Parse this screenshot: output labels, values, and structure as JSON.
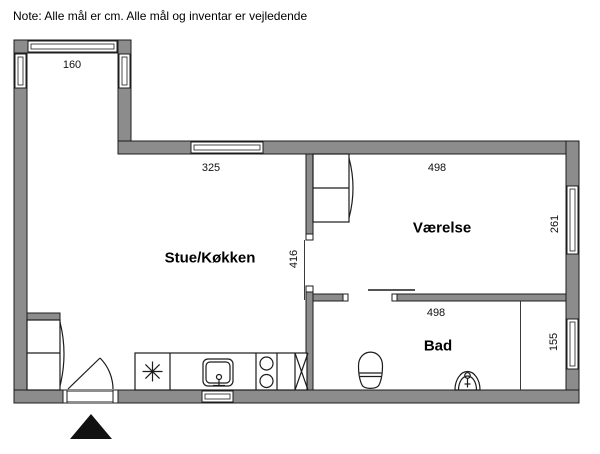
{
  "note": {
    "text": "Note: Alle mål er cm. Alle mål og inventar er vejledende"
  },
  "rooms": {
    "living_kitchen": {
      "label": "Stue/Køkken"
    },
    "bedroom": {
      "label": "Værelse"
    },
    "bathroom": {
      "label": "Bad"
    }
  },
  "dimensions": {
    "entry_bay_width": "160",
    "kitchen_window_wall": "325",
    "bedroom_width": "498",
    "bedroom_depth": "261",
    "living_room_depth": "416",
    "bathroom_width": "498",
    "bathroom_niche_depth": "155"
  },
  "fixtures": {
    "icons": [
      "window",
      "entrance-door",
      "sliding-door",
      "wardrobe",
      "kitchen-counter",
      "kitchen-sink",
      "cooktop",
      "appliance-crossbox",
      "asterisk-symbol",
      "toilet",
      "bathroom-sink",
      "entrance-marker"
    ]
  },
  "colors": {
    "wall": "#8c8c8c",
    "outline": "#1c1c1c",
    "background": "#ffffff",
    "entrance_marker": "#111111"
  }
}
